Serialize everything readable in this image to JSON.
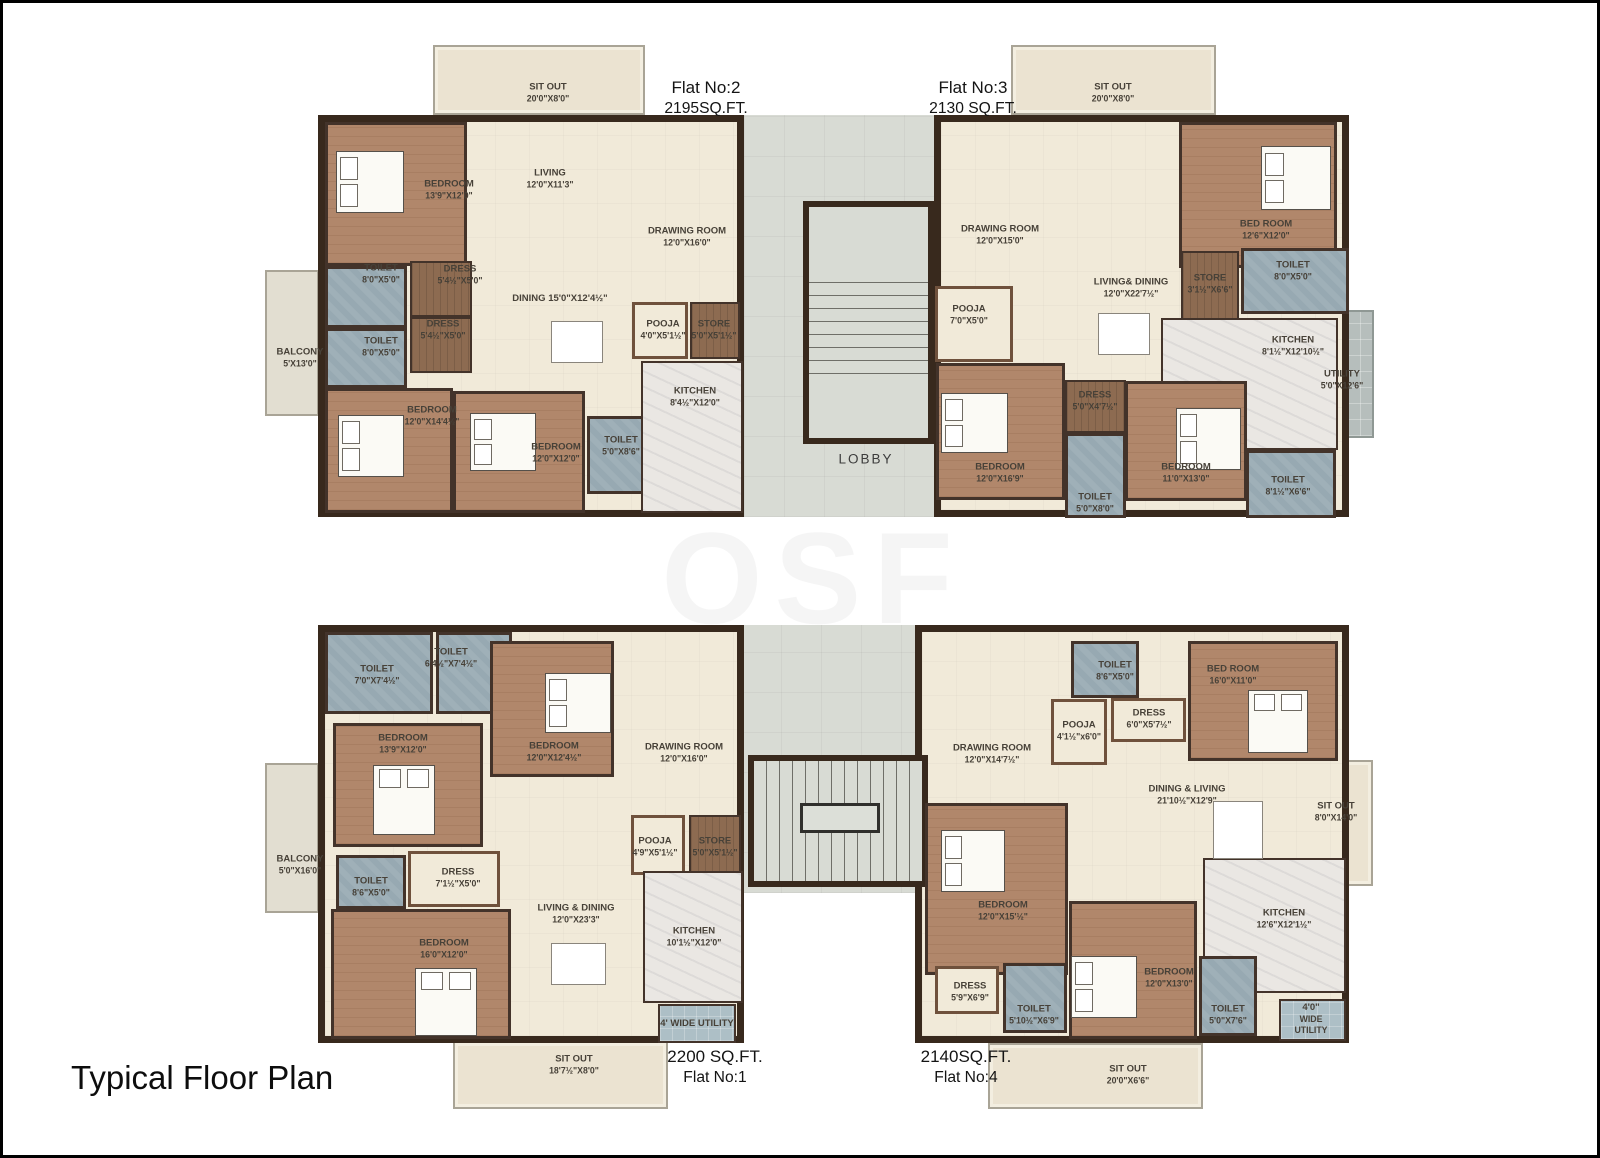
{
  "title": "Typical Floor  Plan",
  "watermark": "OSF",
  "palette": {
    "wall": "#38291d",
    "floor": "#f1ead9",
    "bedroom": "#b1876b",
    "toilet": "#97a9b2",
    "wood": "#8d6b51",
    "kitchen": "#eae7e3",
    "sitout": "#ebe3d1",
    "balcony": "#e2ded1",
    "utility_tile": "#b6bebc",
    "utility_blue": "#adbfc6",
    "corridor": "#d8dbd4",
    "label": "#474138"
  },
  "areas": [
    {
      "t": "sitout",
      "n": "flat2-sitout",
      "x": 430,
      "y": 42,
      "w": 212,
      "h": 70
    },
    {
      "t": "sitout",
      "n": "flat3-sitout",
      "x": 1008,
      "y": 42,
      "w": 205,
      "h": 70
    },
    {
      "t": "balcony",
      "n": "flat2-balcony",
      "x": 262,
      "y": 267,
      "w": 54,
      "h": 146
    },
    {
      "t": "utility",
      "n": "flat3-utility",
      "x": 1307,
      "y": 307,
      "w": 64,
      "h": 128
    },
    {
      "t": "balcony",
      "n": "flat1-balcony",
      "x": 262,
      "y": 760,
      "w": 54,
      "h": 150
    },
    {
      "t": "sitout",
      "n": "flat1-sitout",
      "x": 450,
      "y": 1038,
      "w": 215,
      "h": 68
    },
    {
      "t": "sitout",
      "n": "flat4-sitout-right",
      "x": 1297,
      "y": 757,
      "w": 73,
      "h": 126
    },
    {
      "t": "sitout",
      "n": "flat4-sitout-bottom",
      "x": 985,
      "y": 1040,
      "w": 215,
      "h": 66
    },
    {
      "t": "corridor",
      "n": "lobby-corridor-top",
      "x": 741,
      "y": 112,
      "w": 190,
      "h": 402
    },
    {
      "t": "corridor",
      "n": "lobby-corridor-bottom",
      "x": 738,
      "y": 622,
      "w": 186,
      "h": 268
    },
    {
      "t": "body",
      "n": "flat2-body",
      "x": 315,
      "y": 112,
      "w": 426,
      "h": 402
    },
    {
      "t": "body",
      "n": "flat3-body",
      "x": 931,
      "y": 112,
      "w": 415,
      "h": 402
    },
    {
      "t": "body",
      "n": "flat1-body",
      "x": 315,
      "y": 622,
      "w": 426,
      "h": 418
    },
    {
      "t": "body",
      "n": "flat4-body",
      "x": 912,
      "y": 622,
      "w": 434,
      "h": 418
    },
    {
      "t": "stairbox",
      "n": "stairwell-top",
      "x": 800,
      "y": 198,
      "w": 131,
      "h": 243
    },
    {
      "t": "treads-v",
      "n": "stair-treads-top",
      "x": 806,
      "y": 267,
      "w": 119,
      "h": 106
    },
    {
      "t": "stairbox",
      "n": "stairwell-bottom",
      "x": 745,
      "y": 752,
      "w": 180,
      "h": 132
    },
    {
      "t": "treads-h",
      "n": "stair-treads-bottom",
      "x": 751,
      "y": 758,
      "w": 168,
      "h": 120
    },
    {
      "t": "landing",
      "n": "stair-landing",
      "x": 797,
      "y": 800,
      "w": 80,
      "h": 30
    },
    {
      "t": "bedroom",
      "x": 322,
      "y": 119,
      "w": 142,
      "h": 144
    },
    {
      "t": "toilet",
      "x": 322,
      "y": 263,
      "w": 82,
      "h": 62
    },
    {
      "t": "wood",
      "x": 407,
      "y": 258,
      "w": 62,
      "h": 56
    },
    {
      "t": "toilet",
      "x": 322,
      "y": 325,
      "w": 82,
      "h": 60
    },
    {
      "t": "wood",
      "x": 407,
      "y": 314,
      "w": 62,
      "h": 56
    },
    {
      "t": "bedroom",
      "x": 322,
      "y": 385,
      "w": 128,
      "h": 125
    },
    {
      "t": "bedroom",
      "x": 450,
      "y": 388,
      "w": 132,
      "h": 122
    },
    {
      "t": "toilet",
      "x": 584,
      "y": 413,
      "w": 66,
      "h": 78
    },
    {
      "t": "pooja",
      "x": 629,
      "y": 299,
      "w": 56,
      "h": 57
    },
    {
      "t": "wood",
      "x": 687,
      "y": 299,
      "w": 50,
      "h": 57
    },
    {
      "t": "kitchen",
      "x": 638,
      "y": 358,
      "w": 102,
      "h": 152
    },
    {
      "t": "bedroom",
      "x": 1176,
      "y": 119,
      "w": 158,
      "h": 146
    },
    {
      "t": "wood",
      "x": 1178,
      "y": 248,
      "w": 58,
      "h": 92
    },
    {
      "t": "toilet",
      "x": 1238,
      "y": 245,
      "w": 108,
      "h": 66
    },
    {
      "t": "pooja",
      "x": 932,
      "y": 283,
      "w": 78,
      "h": 76
    },
    {
      "t": "kitchen",
      "x": 1158,
      "y": 315,
      "w": 177,
      "h": 132
    },
    {
      "t": "bedroom",
      "x": 933,
      "y": 360,
      "w": 129,
      "h": 137
    },
    {
      "t": "wood",
      "x": 1062,
      "y": 377,
      "w": 61,
      "h": 53
    },
    {
      "t": "toilet",
      "x": 1062,
      "y": 430,
      "w": 61,
      "h": 85
    },
    {
      "t": "bedroom",
      "x": 1122,
      "y": 378,
      "w": 122,
      "h": 120
    },
    {
      "t": "toilet",
      "x": 1243,
      "y": 447,
      "w": 90,
      "h": 68
    },
    {
      "t": "toilet",
      "x": 322,
      "y": 629,
      "w": 108,
      "h": 82
    },
    {
      "t": "toilet",
      "x": 433,
      "y": 629,
      "w": 76,
      "h": 82
    },
    {
      "t": "bedroom",
      "x": 487,
      "y": 638,
      "w": 124,
      "h": 136
    },
    {
      "t": "bedroom",
      "x": 330,
      "y": 720,
      "w": 150,
      "h": 124
    },
    {
      "t": "toilet",
      "x": 333,
      "y": 852,
      "w": 70,
      "h": 54
    },
    {
      "t": "pooja",
      "x": 405,
      "y": 848,
      "w": 92,
      "h": 56
    },
    {
      "t": "bedroom",
      "x": 328,
      "y": 906,
      "w": 180,
      "h": 130
    },
    {
      "t": "pooja",
      "x": 628,
      "y": 812,
      "w": 54,
      "h": 60
    },
    {
      "t": "wood",
      "x": 686,
      "y": 812,
      "w": 52,
      "h": 60
    },
    {
      "t": "kitchen",
      "x": 640,
      "y": 868,
      "w": 100,
      "h": 132
    },
    {
      "t": "utilityb",
      "x": 655,
      "y": 1001,
      "w": 78,
      "h": 39
    },
    {
      "t": "toilet",
      "x": 1068,
      "y": 638,
      "w": 68,
      "h": 57
    },
    {
      "t": "bedroom",
      "x": 1185,
      "y": 638,
      "w": 150,
      "h": 120
    },
    {
      "t": "pooja",
      "x": 1108,
      "y": 695,
      "w": 75,
      "h": 44
    },
    {
      "t": "pooja",
      "x": 1048,
      "y": 696,
      "w": 56,
      "h": 66
    },
    {
      "t": "bedroom",
      "x": 922,
      "y": 800,
      "w": 143,
      "h": 172
    },
    {
      "t": "pooja",
      "x": 932,
      "y": 963,
      "w": 64,
      "h": 48
    },
    {
      "t": "toilet",
      "x": 1000,
      "y": 960,
      "w": 64,
      "h": 70
    },
    {
      "t": "kitchen",
      "x": 1200,
      "y": 855,
      "w": 143,
      "h": 135
    },
    {
      "t": "bedroom",
      "x": 1066,
      "y": 898,
      "w": 128,
      "h": 138
    },
    {
      "t": "toilet",
      "x": 1196,
      "y": 953,
      "w": 58,
      "h": 80
    },
    {
      "t": "utilityb",
      "x": 1276,
      "y": 996,
      "w": 67,
      "h": 42
    }
  ],
  "beds": [
    {
      "x": 333,
      "y": 148,
      "w": 68,
      "h": 62
    },
    {
      "x": 335,
      "y": 412,
      "w": 66,
      "h": 62
    },
    {
      "x": 467,
      "y": 410,
      "w": 66,
      "h": 58
    },
    {
      "x": 1258,
      "y": 143,
      "w": 70,
      "h": 64
    },
    {
      "x": 938,
      "y": 390,
      "w": 67,
      "h": 60
    },
    {
      "x": 1173,
      "y": 405,
      "w": 65,
      "h": 62
    },
    {
      "x": 542,
      "y": 670,
      "w": 66,
      "h": 60
    },
    {
      "x": 370,
      "y": 762,
      "w": 62,
      "h": 70
    },
    {
      "x": 412,
      "y": 965,
      "w": 62,
      "h": 68
    },
    {
      "x": 1245,
      "y": 687,
      "w": 60,
      "h": 63
    },
    {
      "x": 938,
      "y": 827,
      "w": 64,
      "h": 62
    },
    {
      "x": 1068,
      "y": 953,
      "w": 66,
      "h": 62
    }
  ],
  "furniture": [
    {
      "x": 548,
      "y": 318,
      "w": 52,
      "h": 42
    },
    {
      "x": 1095,
      "y": 310,
      "w": 52,
      "h": 42
    },
    {
      "x": 548,
      "y": 940,
      "w": 55,
      "h": 42
    },
    {
      "x": 1210,
      "y": 798,
      "w": 50,
      "h": 58
    }
  ],
  "labels": [
    {
      "x": 545,
      "y": 90,
      "lines": [
        "SIT OUT",
        "20'0\"X8'0\""
      ]
    },
    {
      "x": 1110,
      "y": 90,
      "lines": [
        "SIT OUT",
        "20'0\"X8'0\""
      ]
    },
    {
      "x": 703,
      "y": 95,
      "cls": "header",
      "n": "flat-2-label",
      "lines": [
        "Flat No:2",
        "2195SQ.FT."
      ]
    },
    {
      "x": 970,
      "y": 95,
      "cls": "header",
      "n": "flat-3-label",
      "lines": [
        "Flat No:3",
        "2130 SQ.FT."
      ]
    },
    {
      "x": 446,
      "y": 187,
      "lines": [
        "BEDROOM",
        "13'9\"X12'0\""
      ]
    },
    {
      "x": 547,
      "y": 176,
      "lines": [
        "LIVING",
        "12'0\"X11'3\""
      ]
    },
    {
      "x": 684,
      "y": 234,
      "lines": [
        "DRAWING ROOM",
        "12'0\"X16'0\""
      ]
    },
    {
      "x": 378,
      "y": 271,
      "lines": [
        "TOILET",
        "8'0\"X5'0\""
      ]
    },
    {
      "x": 457,
      "y": 272,
      "lines": [
        "DRESS",
        "5'4½\"X5'0\""
      ]
    },
    {
      "x": 557,
      "y": 296,
      "lines": [
        "DINING 15'0\"X12'4½\""
      ]
    },
    {
      "x": 440,
      "y": 327,
      "lines": [
        "DRESS",
        "5'4½\"X5'0\""
      ]
    },
    {
      "x": 378,
      "y": 344,
      "lines": [
        "TOILET",
        "8'0\"X5'0\""
      ]
    },
    {
      "x": 297,
      "y": 355,
      "lines": [
        "BALCONY",
        "5'X13'0\""
      ]
    },
    {
      "x": 660,
      "y": 327,
      "lines": [
        "POOJA",
        "4'0\"X5'1½\""
      ]
    },
    {
      "x": 711,
      "y": 327,
      "lines": [
        "STORE",
        "5'0\"X5'1½\""
      ]
    },
    {
      "x": 692,
      "y": 394,
      "lines": [
        "KITCHEN",
        "8'4½\"X12'0\""
      ]
    },
    {
      "x": 429,
      "y": 413,
      "lines": [
        "BEDROOM",
        "12'0\"X14'4½\""
      ]
    },
    {
      "x": 553,
      "y": 450,
      "lines": [
        "BEDROOM",
        "12'0\"X12'0\""
      ]
    },
    {
      "x": 618,
      "y": 443,
      "lines": [
        "TOILET",
        "5'0\"X8'6\""
      ]
    },
    {
      "x": 997,
      "y": 232,
      "lines": [
        "DRAWING ROOM",
        "12'0\"X15'0\""
      ]
    },
    {
      "x": 1263,
      "y": 227,
      "lines": [
        "BED ROOM",
        "12'6\"X12'0\""
      ]
    },
    {
      "x": 1128,
      "y": 285,
      "lines": [
        "LIVING& DINING",
        "12'0\"X22'7½\""
      ]
    },
    {
      "x": 966,
      "y": 312,
      "lines": [
        "POOJA",
        "7'0\"X5'0\""
      ]
    },
    {
      "x": 1207,
      "y": 281,
      "lines": [
        "STORE",
        "3'1½\"X6'6\""
      ]
    },
    {
      "x": 1290,
      "y": 268,
      "lines": [
        "TOILET",
        "8'0\"X5'0\""
      ]
    },
    {
      "x": 1290,
      "y": 343,
      "lines": [
        "KITCHEN",
        "8'1½\"X12'10½\""
      ]
    },
    {
      "x": 1339,
      "y": 377,
      "lines": [
        "UTILITY",
        "5'0\"X12'6\""
      ]
    },
    {
      "x": 997,
      "y": 470,
      "lines": [
        "BEDROOM",
        "12'0\"X16'9\""
      ]
    },
    {
      "x": 1092,
      "y": 398,
      "lines": [
        "DRESS",
        "5'0\"X4'7½\""
      ]
    },
    {
      "x": 1092,
      "y": 500,
      "lines": [
        "TOILET",
        "5'0\"X8'0\""
      ]
    },
    {
      "x": 1183,
      "y": 470,
      "lines": [
        "BEDROOM",
        "11'0\"X13'0\""
      ]
    },
    {
      "x": 1285,
      "y": 483,
      "lines": [
        "TOILET",
        "8'1½\"X6'6\""
      ]
    },
    {
      "x": 863,
      "y": 457,
      "cls": "lobby",
      "n": "lobby-label",
      "lines": [
        "LOBBY"
      ]
    },
    {
      "x": 374,
      "y": 672,
      "lines": [
        "TOILET",
        "7'0\"X7'4½\""
      ]
    },
    {
      "x": 448,
      "y": 655,
      "lines": [
        "TOILET",
        "6'4½\"X7'4½\""
      ]
    },
    {
      "x": 400,
      "y": 741,
      "lines": [
        "BEDROOM",
        "13'9\"X12'0\""
      ]
    },
    {
      "x": 551,
      "y": 749,
      "lines": [
        "BEDROOM",
        "12'0\"X12'4½\""
      ]
    },
    {
      "x": 681,
      "y": 750,
      "lines": [
        "DRAWING ROOM",
        "12'0\"X16'0\""
      ]
    },
    {
      "x": 652,
      "y": 844,
      "lines": [
        "POOJA",
        "4'9\"X5'1½\""
      ]
    },
    {
      "x": 712,
      "y": 844,
      "lines": [
        "STORE",
        "5'0\"X5'1½\""
      ]
    },
    {
      "x": 455,
      "y": 875,
      "lines": [
        "DRESS",
        "7'1½\"X5'0\""
      ]
    },
    {
      "x": 297,
      "y": 862,
      "lines": [
        "BALCONY",
        "5'0\"X16'0\""
      ]
    },
    {
      "x": 368,
      "y": 884,
      "lines": [
        "TOILET",
        "8'6\"X5'0\""
      ]
    },
    {
      "x": 441,
      "y": 946,
      "lines": [
        "BEDROOM",
        "16'0\"X12'0\""
      ]
    },
    {
      "x": 573,
      "y": 911,
      "lines": [
        "LIVING & DINING",
        "12'0\"X23'3\""
      ]
    },
    {
      "x": 691,
      "y": 934,
      "lines": [
        "KITCHEN",
        "10'1½\"X12'0\""
      ]
    },
    {
      "x": 694,
      "y": 1021,
      "lines": [
        "4' WIDE UTILITY"
      ]
    },
    {
      "x": 571,
      "y": 1062,
      "lines": [
        "SIT OUT",
        "18'7½\"X8'0\""
      ]
    },
    {
      "x": 712,
      "y": 1064,
      "cls": "header",
      "n": "flat-1-label",
      "lines": [
        "2200 SQ.FT.",
        "Flat No:1"
      ]
    },
    {
      "x": 1112,
      "y": 668,
      "lines": [
        "TOILET",
        "8'6\"X5'0\""
      ]
    },
    {
      "x": 1230,
      "y": 672,
      "lines": [
        "BED ROOM",
        "16'0\"X11'0\""
      ]
    },
    {
      "x": 1146,
      "y": 716,
      "lines": [
        "DRESS",
        "6'0\"X5'7½\""
      ]
    },
    {
      "x": 1076,
      "y": 728,
      "lines": [
        "POOJA",
        "4'1½\"x6'0\""
      ]
    },
    {
      "x": 989,
      "y": 751,
      "lines": [
        "DRAWING ROOM",
        "12'0\"X14'7½\""
      ]
    },
    {
      "x": 1184,
      "y": 792,
      "lines": [
        "DINING & LIVING",
        "21'10½\"X12'9\""
      ]
    },
    {
      "x": 1333,
      "y": 809,
      "lines": [
        "SIT OUT",
        "8'0\"X14'0\""
      ]
    },
    {
      "x": 1000,
      "y": 908,
      "lines": [
        "BEDROOM",
        "12'0\"X15'½\""
      ]
    },
    {
      "x": 967,
      "y": 989,
      "lines": [
        "DRESS",
        "5'9\"X6'9\""
      ]
    },
    {
      "x": 1031,
      "y": 1012,
      "lines": [
        "TOILET",
        "5'10½\"X6'9\""
      ]
    },
    {
      "x": 1166,
      "y": 975,
      "lines": [
        "BEDROOM",
        "12'0\"X13'0\""
      ]
    },
    {
      "x": 1225,
      "y": 1012,
      "lines": [
        "TOILET",
        "5'0\"X7'6\""
      ]
    },
    {
      "x": 1281,
      "y": 916,
      "lines": [
        "KITCHEN",
        "12'6\"X12'1½\""
      ]
    },
    {
      "x": 1308,
      "y": 1016,
      "lines": [
        "4'0\"",
        "WIDE",
        "UTILITY"
      ]
    },
    {
      "x": 1125,
      "y": 1072,
      "lines": [
        "SIT OUT",
        "20'0\"X6'6\""
      ]
    },
    {
      "x": 963,
      "y": 1064,
      "cls": "header",
      "n": "flat-4-label",
      "lines": [
        "2140SQ.FT.",
        "Flat No:4"
      ]
    }
  ]
}
